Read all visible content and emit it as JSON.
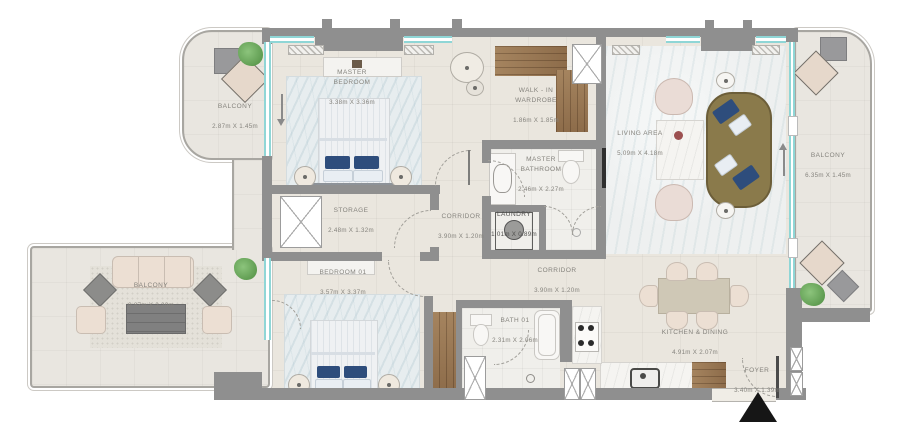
{
  "colors": {
    "wall": "#8f8f8f",
    "floor": "#eae6de",
    "balcony_floor": "#e9e6e0",
    "window_glass": "#8fd6d6",
    "wood": "#9a7a58",
    "sofa_olive": "#8a7a4b",
    "accent_pillow_navy": "#2e4d7c",
    "entrance_marker": "#161616",
    "label_text": "#85837d"
  },
  "markers": {
    "entrance_triangle": "▲",
    "balcony_left_arrow": "down",
    "balcony_right_arrow": "up"
  },
  "rooms": [
    {
      "id": "balcony-top-left",
      "name": "BALCONY",
      "dims": "2.87m X 1.45m"
    },
    {
      "id": "master-bedroom",
      "name": "MASTER\nBEDROOM",
      "dims": "3.38m X 3.36m"
    },
    {
      "id": "walk-in-wardrobe",
      "name": "WALK - IN\nWARDROBE",
      "dims": "1.86m X 1.85m"
    },
    {
      "id": "living-area",
      "name": "LIVING AREA",
      "dims": "5.09m X 4.18m"
    },
    {
      "id": "balcony-right",
      "name": "BALCONY",
      "dims": "6.35m X 1.45m"
    },
    {
      "id": "master-bathroom",
      "name": "MASTER\nBATHROOM",
      "dims": "2.46m X 2.27m"
    },
    {
      "id": "storage",
      "name": "STORAGE",
      "dims": "2.48m X 1.32m"
    },
    {
      "id": "corridor-upper",
      "name": "CORRIDOR",
      "dims": "3.90m X 1.20m"
    },
    {
      "id": "laundry",
      "name": "LAUNDRY",
      "dims": "1.01m X 0.89m"
    },
    {
      "id": "bedroom-01",
      "name": "BEDROOM 01",
      "dims": "3.57m X 3.37m"
    },
    {
      "id": "balcony-bottom",
      "name": "BALCONY",
      "dims": "9.87m X 2.20m"
    },
    {
      "id": "corridor-lower",
      "name": "CORRIDOR",
      "dims": "3.90m X 1.20m"
    },
    {
      "id": "bath-01",
      "name": "BATH 01",
      "dims": "2.31m X 2.06m"
    },
    {
      "id": "kitchen-dining",
      "name": "KITCHEN & DINING",
      "dims": "4.91m X 2.07m"
    },
    {
      "id": "foyer",
      "name": "FOYER",
      "dims": "3.40m X 1.39m"
    }
  ]
}
